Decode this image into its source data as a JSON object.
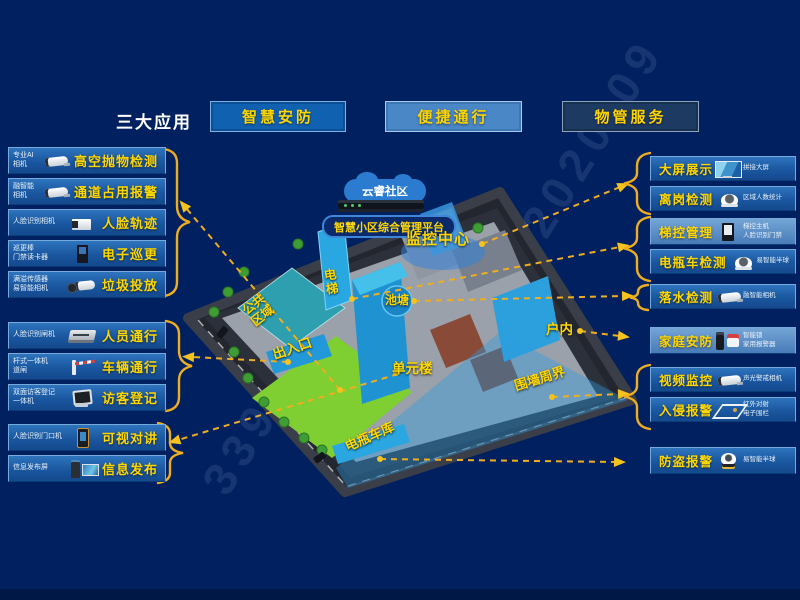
{
  "header": {
    "title": "三大应用",
    "apps": [
      {
        "label": "智慧安防"
      },
      {
        "label": "便捷通行"
      },
      {
        "label": "物管服务"
      }
    ]
  },
  "left": {
    "rows": [
      {
        "device": "专业AI相机",
        "label": "高空抛物检测"
      },
      {
        "device": "融智能相机",
        "label": "通道占用报警"
      },
      {
        "device": "人脸识别相机",
        "label": "人脸轨迹"
      },
      {
        "device": "巡更棒\n门禁读卡器",
        "label": "电子巡更"
      },
      {
        "device": "满溢传感器\n易智能相机",
        "label": "垃圾投放"
      },
      {
        "device": "人脸识别闸机",
        "label": "人员通行"
      },
      {
        "device": "杆式一体机\n道闸",
        "label": "车辆通行"
      },
      {
        "device": "双面访客登记\n一体机",
        "label": "访客登记"
      },
      {
        "device": "人脸识别门口机",
        "label": "可视对讲"
      },
      {
        "device": "信息发布屏",
        "label": "信息发布"
      }
    ]
  },
  "right": {
    "rows": [
      {
        "label": "大屏展示",
        "device": "拼接大屏"
      },
      {
        "label": "离岗检测",
        "device": "区域人数统计"
      },
      {
        "label": "梯控管理",
        "device": "梯控主机\n人脸识别门禁"
      },
      {
        "label": "电瓶车检测",
        "device": "易智能半球"
      },
      {
        "label": "落水检测",
        "device": "融智能相机"
      },
      {
        "label": "家庭安防",
        "device": "智能锁\n家用报警器"
      },
      {
        "label": "视频监控",
        "device": "声光警戒相机"
      },
      {
        "label": "入侵报警",
        "device": "红外对射\n电子围栏"
      },
      {
        "label": "防盗报警",
        "device": "易智能半球"
      }
    ]
  },
  "map": {
    "cloud": "云睿社区",
    "platform": "智慧小区综合管理平台",
    "monitor_center": "监控中心",
    "elevator": "电\n梯",
    "pond": "池塘",
    "public_area": "公共\n区域",
    "entrance": "出入口",
    "unit_building": "单元楼",
    "indoor": "户内",
    "perimeter": "围墙周界",
    "bike_garage": "电瓶车库"
  },
  "watermark": {
    "line1": "2020-09",
    "line2": "339"
  },
  "colors": {
    "background": "#00205f",
    "accent_yellow": "#ffd600",
    "connector_yellow": "#efae1f",
    "row_blue": "#1a57a0",
    "map_blue": "#2aa6e0"
  }
}
